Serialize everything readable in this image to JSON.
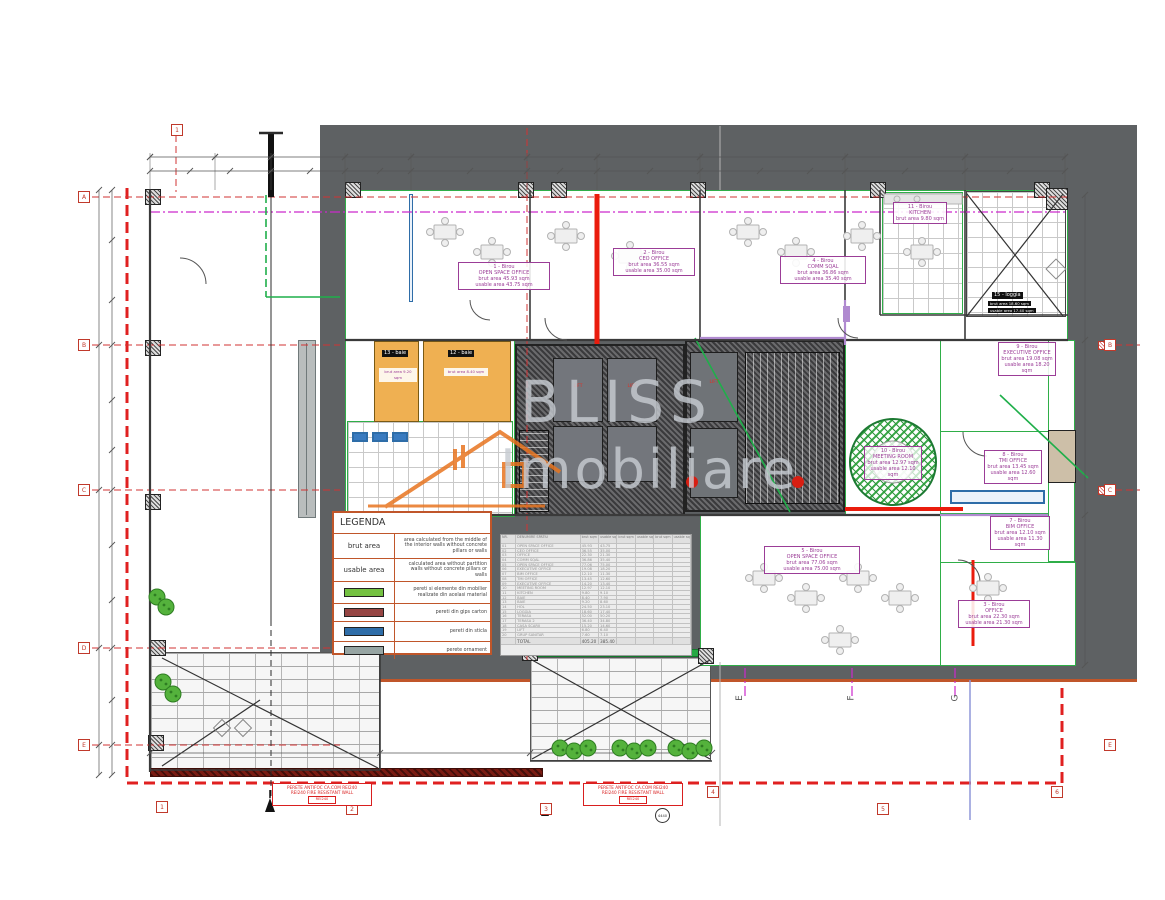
{
  "watermark": {
    "line1": "BLISS",
    "line2": "Imobiliare"
  },
  "legend": {
    "title": "LEGENDA",
    "rows": [
      {
        "term": "brut area",
        "swatch": "",
        "desc": "area calculated from the middle of the interior walls without concrete pillars or walls"
      },
      {
        "term": "usable area",
        "swatch": "",
        "desc": "calculated area without partition walls without concrete pillars or walls"
      },
      {
        "term": "",
        "swatch": "#74c141",
        "desc": "pereti si elemente din mobilier realizate din acelasi material"
      },
      {
        "term": "",
        "swatch": "#964543",
        "desc": "pereti din gips carton"
      },
      {
        "term": "",
        "swatch": "#2e6da8",
        "desc": "pereti din sticla"
      },
      {
        "term": "",
        "swatch": "#97a5a3",
        "desc": "perete ornament"
      }
    ]
  },
  "grid": {
    "top1": "1",
    "left": [
      "A",
      "B",
      "C",
      "D",
      "E"
    ],
    "right": [
      "B",
      "C",
      "E"
    ],
    "bottom": [
      "1",
      "2",
      "3",
      "4",
      "5",
      "6"
    ],
    "rotated": [
      "E",
      "F",
      "G"
    ]
  },
  "rooms": {
    "room1": {
      "l1": "1 - Birou",
      "l2": "OPEN SPACE OFFICE",
      "l3": "brut area 45.93 sqm",
      "l4": "usable area 43.75 sqm"
    },
    "room2": {
      "l1": "2 - Birou",
      "l2": "CEO OFFICE",
      "l3": "brut area 36.55 sqm",
      "l4": "usable area 35.00 sqm"
    },
    "room3": {
      "l1": "3 - Birou",
      "l2": "OFFICE",
      "l3": "brut area 22.30 sqm",
      "l4": "usable area 21.30 sqm"
    },
    "room4": {
      "l1": "4 - Birou",
      "l2": "COMM SQAL",
      "l3": "brut area 36.86 sqm",
      "l4": "usable area 35.40 sqm"
    },
    "room5": {
      "l1": "5 - Birou",
      "l2": "OPEN SPACE OFFICE",
      "l3": "brut area 77.06 sqm",
      "l4": "usable area 75.00 sqm"
    },
    "room9": {
      "l1": "9 - Birou",
      "l2": "EXECUTIVE OFFICE",
      "l3": "brut area 19.08 sqm",
      "l4": "usable area 18.20 sqm"
    },
    "room8": {
      "l1": "8 - Birou",
      "l2": "TMI OFFICE",
      "l3": "brut area 13.45 sqm",
      "l4": "usable area 12.60 sqm"
    },
    "room7": {
      "l1": "7 - Birou",
      "l2": "BIM OFFICE",
      "l3": "brut area 12.10 sqm",
      "l4": "usable area 11.30 sqm"
    },
    "meeting": {
      "l1": "10 - Birou",
      "l2": "MEETING ROOM",
      "l3": "brut area 12.97 sqm",
      "l4": "usable area 12.10 sqm"
    },
    "kitchen": {
      "l1": "11 - Birou",
      "l2": "KITCHEN",
      "l3": "brut area 9.80 sqm"
    },
    "baie12": "12 - baie",
    "baie13": "13 - baie",
    "baie12_area": "brut area 8.40 sqm",
    "baie13_area": "brut area 9.20 sqm",
    "loggia": "15 - loggia",
    "loggia_brut": "brut area 18.60 sqm",
    "loggia_usable": "usable area 17.40 sqm",
    "lift": "LIFT"
  },
  "fire_label": {
    "line1": "PERETE ANTIFOC CA.COM REI240",
    "line2": "REI240 FIRE RESISTANT WALL",
    "tag": "REI240"
  },
  "section_marker": "4440",
  "schedule": {
    "headers": [
      "NR.",
      "DENUMIRE SPATIU",
      "brut sqm",
      "usable sqm",
      "brut sqm",
      "usable sqm",
      "brut sqm",
      "usable sqm"
    ],
    "rows": [
      [
        "01",
        "OPEN SPACE OFFICE",
        "45.93",
        "43.75"
      ],
      [
        "02",
        "CEO OFFICE",
        "36.55",
        "35.00"
      ],
      [
        "03",
        "OFFICE",
        "22.30",
        "21.30"
      ],
      [
        "04",
        "COMM SQAL",
        "36.86",
        "35.40"
      ],
      [
        "05",
        "OPEN SPACE OFFICE",
        "77.06",
        "75.00"
      ],
      [
        "06",
        "EXECUTIVE OFFICE",
        "19.08",
        "18.20"
      ],
      [
        "07",
        "BIM OFFICE",
        "12.10",
        "11.30"
      ],
      [
        "08",
        "TMI OFFICE",
        "13.45",
        "12.60"
      ],
      [
        "09",
        "EXECUTIVE OFFICE",
        "14.20",
        "13.40"
      ],
      [
        "10",
        "MEETING ROOM",
        "12.97",
        "12.10"
      ],
      [
        "11",
        "KITCHEN",
        "9.80",
        "9.10"
      ],
      [
        "12",
        "BAIE",
        "8.40",
        "7.90"
      ],
      [
        "13",
        "BAIE",
        "9.20",
        "8.60"
      ],
      [
        "14",
        "HOL",
        "24.50",
        "23.10"
      ],
      [
        "15",
        "LOGGIA",
        "18.60",
        "17.40"
      ],
      [
        "16",
        "TERASA",
        "52.00",
        "50.20"
      ],
      [
        "17",
        "TERASA 2",
        "36.40",
        "34.80"
      ],
      [
        "18",
        "CASA SCARII",
        "15.20",
        "14.60"
      ],
      [
        "19",
        "LIFT",
        "6.80",
        "6.40"
      ],
      [
        "20",
        "GRUP SANITAR",
        "7.60",
        "7.10"
      ]
    ],
    "total": [
      "",
      "TOTAL",
      "405.20",
      "385.40"
    ]
  },
  "colors": {
    "accent_orange": "#c0562a",
    "wall_green": "#2fae48",
    "glass_blue": "#2e6da8",
    "gips_red": "#964543",
    "ornament_gray": "#97a5a3",
    "label_purple": "#9b3d97",
    "fire_red": "#d91f1f",
    "boundary_red": "#e02020"
  }
}
